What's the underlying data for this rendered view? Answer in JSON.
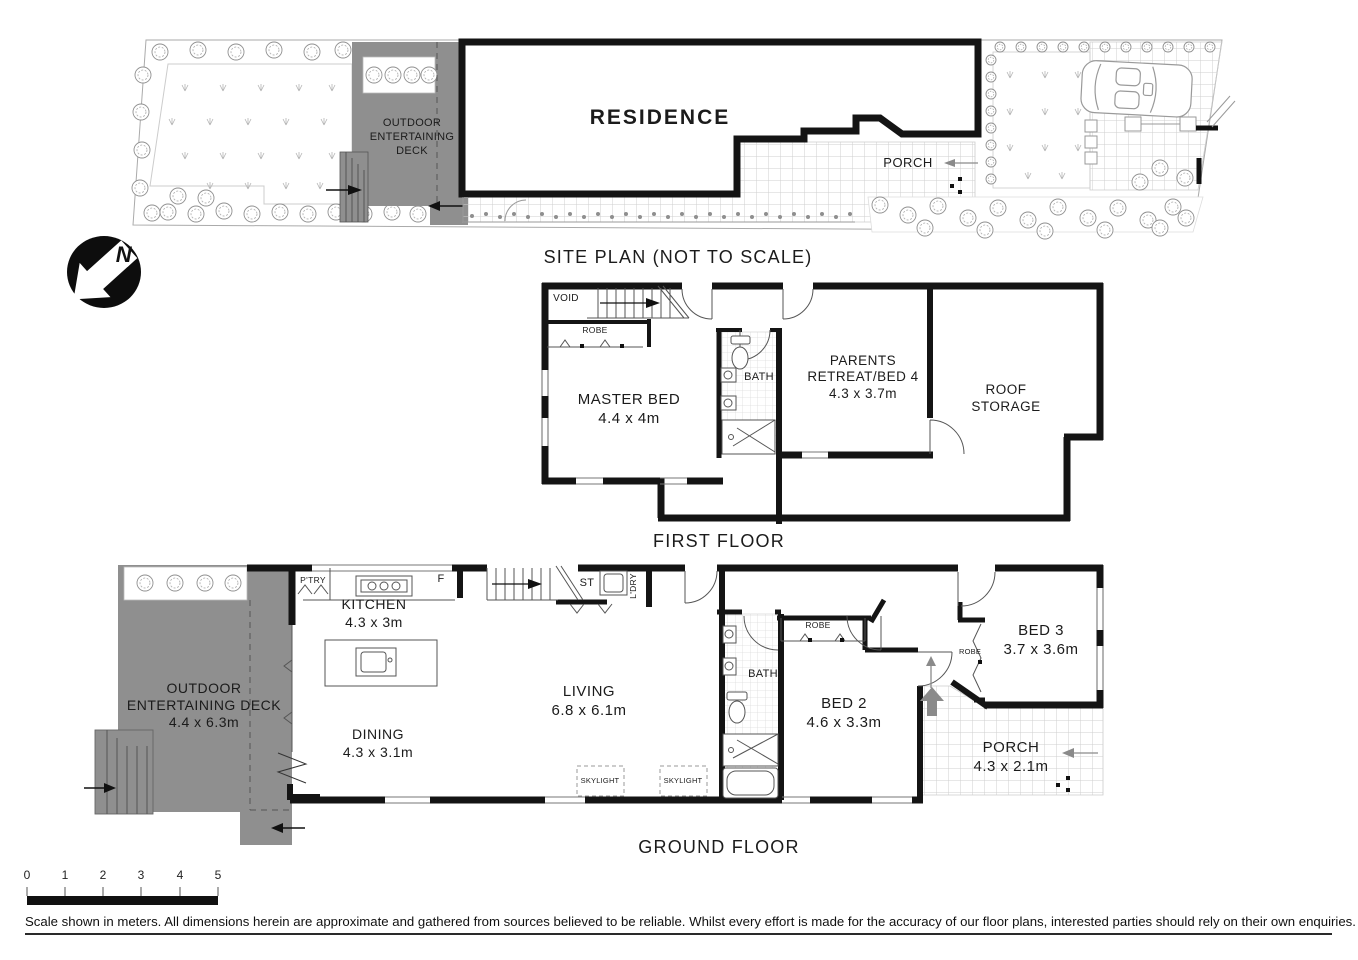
{
  "site_plan": {
    "title": "SITE PLAN (NOT TO SCALE)",
    "residence_label": "RESIDENCE",
    "deck_line1": "OUTDOOR",
    "deck_line2": "ENTERTAINING",
    "deck_line3": "DECK",
    "porch_label": "PORCH",
    "north_letter": "N"
  },
  "first_floor": {
    "title": "FIRST FLOOR",
    "void_label": "VOID",
    "robe_label": "ROBE",
    "bath_label": "BATH",
    "master_bed": {
      "name": "MASTER BED",
      "dims": "4.4 x 4m"
    },
    "parents_retreat": {
      "line1": "PARENTS",
      "line2": "RETREAT/BED 4",
      "dims": "4.3 x 3.7m"
    },
    "roof_storage": {
      "line1": "ROOF",
      "line2": "STORAGE"
    }
  },
  "ground_floor": {
    "title": "GROUND FLOOR",
    "pantry_label": "P'TRY",
    "fridge_label": "F",
    "stair_label": "ST",
    "laundry_label": "L'DRY",
    "skylight_label": "SKYLIGHT",
    "bath_label": "BATH",
    "robe_bed2_label": "ROBE",
    "robe_bed3_label": "ROBE",
    "kitchen": {
      "name": "KITCHEN",
      "dims": "4.3 x 3m"
    },
    "deck": {
      "line1": "OUTDOOR",
      "line2": "ENTERTAINING DECK",
      "dims": "4.4 x 6.3m"
    },
    "dining": {
      "name": "DINING",
      "dims": "4.3 x 3.1m"
    },
    "living": {
      "name": "LIVING",
      "dims": "6.8 x 6.1m"
    },
    "bed2": {
      "name": "BED 2",
      "dims": "4.6 x 3.3m"
    },
    "bed3": {
      "name": "BED 3",
      "dims": "3.7 x 3.6m"
    },
    "porch": {
      "name": "PORCH",
      "dims": "4.3 x 2.1m"
    }
  },
  "scale_bar": {
    "ticks": [
      "0",
      "1",
      "2",
      "3",
      "4",
      "5"
    ]
  },
  "disclaimer": "Scale shown in meters. All dimensions herein are approximate and gathered from sources believed to be  reliable. Whilst every effort is made for the accuracy of our floor plans, interested parties should rely on their own enquiries.",
  "colors": {
    "deck_gray": "#8f8f8f",
    "wall_black": "#141414",
    "arrow_gray": "#8a8a8a"
  }
}
